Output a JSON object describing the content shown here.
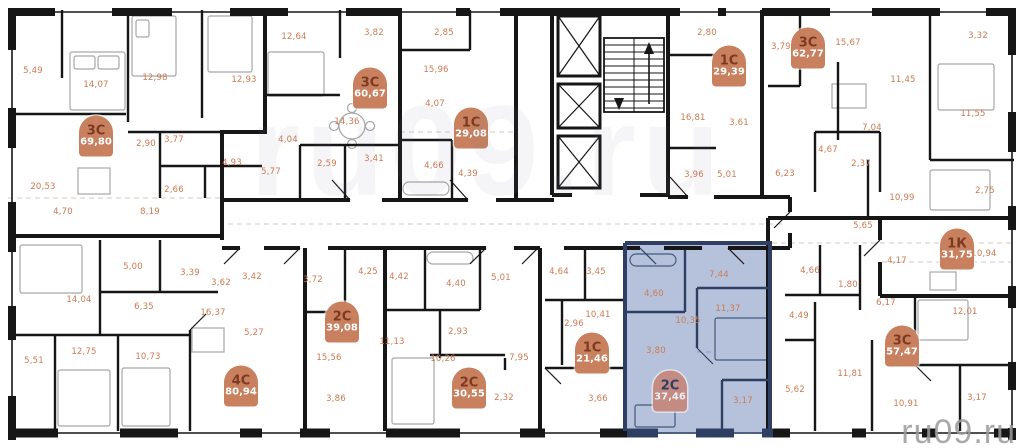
{
  "watermark": {
    "text": "ru09.ru",
    "large_text": "ru09.ru"
  },
  "highlight_color": "#b6c2db",
  "badge_color": "#c8805f",
  "label_color": "#cc7a52",
  "apartments": [
    {
      "id": "3c-69-80",
      "type": "3С",
      "area": "69,80",
      "x": 96,
      "y": 136,
      "highlighted": false
    },
    {
      "id": "3c-60-67",
      "type": "3С",
      "area": "60,67",
      "x": 370,
      "y": 88,
      "highlighted": false
    },
    {
      "id": "1c-29-08",
      "type": "1С",
      "area": "29,08",
      "x": 471,
      "y": 128,
      "highlighted": false
    },
    {
      "id": "1c-29-39",
      "type": "1С",
      "area": "29,39",
      "x": 729,
      "y": 66,
      "highlighted": false
    },
    {
      "id": "3c-62-77",
      "type": "3С",
      "area": "62,77",
      "x": 808,
      "y": 48,
      "highlighted": false
    },
    {
      "id": "1k-31-75",
      "type": "1К",
      "area": "31,75",
      "x": 957,
      "y": 249,
      "highlighted": false
    },
    {
      "id": "3c-57-47",
      "type": "3С",
      "area": "57,47",
      "x": 902,
      "y": 346,
      "highlighted": false
    },
    {
      "id": "4c-80-94",
      "type": "4С",
      "area": "80,94",
      "x": 241,
      "y": 386,
      "highlighted": false
    },
    {
      "id": "2c-39-08",
      "type": "2С",
      "area": "39,08",
      "x": 342,
      "y": 322,
      "highlighted": false
    },
    {
      "id": "2c-30-55",
      "type": "2С",
      "area": "30,55",
      "x": 469,
      "y": 388,
      "highlighted": false
    },
    {
      "id": "1c-21-46",
      "type": "1С",
      "area": "21,46",
      "x": 592,
      "y": 353,
      "highlighted": false
    },
    {
      "id": "2c-37-46",
      "type": "2С",
      "area": "37,46",
      "x": 670,
      "y": 391,
      "highlighted": true
    }
  ],
  "rooms": [
    {
      "v": "5,49",
      "x": 33,
      "y": 71
    },
    {
      "v": "14,07",
      "x": 96,
      "y": 85
    },
    {
      "v": "12,98",
      "x": 155,
      "y": 78
    },
    {
      "v": "12,93",
      "x": 244,
      "y": 80
    },
    {
      "v": "2,90",
      "x": 146,
      "y": 144
    },
    {
      "v": "3,77",
      "x": 174,
      "y": 140
    },
    {
      "v": "4,93",
      "x": 232,
      "y": 163
    },
    {
      "v": "2,66",
      "x": 174,
      "y": 190
    },
    {
      "v": "20,53",
      "x": 43,
      "y": 187
    },
    {
      "v": "4,70",
      "x": 63,
      "y": 212
    },
    {
      "v": "8,19",
      "x": 150,
      "y": 212
    },
    {
      "v": "12,64",
      "x": 294,
      "y": 37
    },
    {
      "v": "3,82",
      "x": 374,
      "y": 33
    },
    {
      "v": "14,36",
      "x": 347,
      "y": 122
    },
    {
      "v": "4,04",
      "x": 288,
      "y": 140
    },
    {
      "v": "2,59",
      "x": 327,
      "y": 164
    },
    {
      "v": "3,41",
      "x": 374,
      "y": 159
    },
    {
      "v": "5,77",
      "x": 271,
      "y": 172
    },
    {
      "v": "2,85",
      "x": 444,
      "y": 33
    },
    {
      "v": "15,96",
      "x": 436,
      "y": 70
    },
    {
      "v": "4,07",
      "x": 435,
      "y": 104
    },
    {
      "v": "4,66",
      "x": 434,
      "y": 166
    },
    {
      "v": "4,39",
      "x": 468,
      "y": 174
    },
    {
      "v": "2,80",
      "x": 707,
      "y": 33
    },
    {
      "v": "16,81",
      "x": 693,
      "y": 118
    },
    {
      "v": "3,61",
      "x": 739,
      "y": 123
    },
    {
      "v": "3,96",
      "x": 694,
      "y": 175
    },
    {
      "v": "5,01",
      "x": 727,
      "y": 175
    },
    {
      "v": "3,79",
      "x": 781,
      "y": 47
    },
    {
      "v": "15,67",
      "x": 848,
      "y": 43
    },
    {
      "v": "3,32",
      "x": 978,
      "y": 36
    },
    {
      "v": "11,45",
      "x": 903,
      "y": 80
    },
    {
      "v": "11,55",
      "x": 973,
      "y": 114
    },
    {
      "v": "7,04",
      "x": 872,
      "y": 128
    },
    {
      "v": "4,67",
      "x": 828,
      "y": 150
    },
    {
      "v": "2,37",
      "x": 861,
      "y": 164
    },
    {
      "v": "6,23",
      "x": 785,
      "y": 174
    },
    {
      "v": "10,99",
      "x": 902,
      "y": 198
    },
    {
      "v": "2,75",
      "x": 985,
      "y": 191
    },
    {
      "v": "4,17",
      "x": 897,
      "y": 261
    },
    {
      "v": "10,94",
      "x": 984,
      "y": 254
    },
    {
      "v": "5,65",
      "x": 863,
      "y": 226
    },
    {
      "v": "4,66",
      "x": 810,
      "y": 271
    },
    {
      "v": "1,80",
      "x": 848,
      "y": 285
    },
    {
      "v": "6,17",
      "x": 886,
      "y": 303
    },
    {
      "v": "4,49",
      "x": 799,
      "y": 316
    },
    {
      "v": "12,01",
      "x": 965,
      "y": 312
    },
    {
      "v": "11,81",
      "x": 850,
      "y": 374
    },
    {
      "v": "5,62",
      "x": 795,
      "y": 390
    },
    {
      "v": "10,91",
      "x": 906,
      "y": 404
    },
    {
      "v": "3,17",
      "x": 977,
      "y": 398
    },
    {
      "v": "5,00",
      "x": 133,
      "y": 267
    },
    {
      "v": "3,39",
      "x": 190,
      "y": 273
    },
    {
      "v": "3,62",
      "x": 221,
      "y": 283
    },
    {
      "v": "14,04",
      "x": 79,
      "y": 300
    },
    {
      "v": "6,35",
      "x": 144,
      "y": 307
    },
    {
      "v": "16,37",
      "x": 213,
      "y": 313
    },
    {
      "v": "12,75",
      "x": 84,
      "y": 352
    },
    {
      "v": "10,73",
      "x": 148,
      "y": 357
    },
    {
      "v": "5,51",
      "x": 34,
      "y": 361
    },
    {
      "v": "3,42",
      "x": 252,
      "y": 277
    },
    {
      "v": "3,72",
      "x": 313,
      "y": 280
    },
    {
      "v": "4,25",
      "x": 368,
      "y": 272
    },
    {
      "v": "5,27",
      "x": 254,
      "y": 333
    },
    {
      "v": "15,56",
      "x": 329,
      "y": 358
    },
    {
      "v": "3,86",
      "x": 336,
      "y": 399
    },
    {
      "v": "4,42",
      "x": 399,
      "y": 277
    },
    {
      "v": "4,40",
      "x": 456,
      "y": 284
    },
    {
      "v": "5,01",
      "x": 501,
      "y": 278
    },
    {
      "v": "11,13",
      "x": 392,
      "y": 342
    },
    {
      "v": "2,93",
      "x": 458,
      "y": 332
    },
    {
      "v": "10,26",
      "x": 443,
      "y": 359
    },
    {
      "v": "7,95",
      "x": 519,
      "y": 358
    },
    {
      "v": "2,32",
      "x": 504,
      "y": 398
    },
    {
      "v": "4,64",
      "x": 559,
      "y": 272
    },
    {
      "v": "3,45",
      "x": 596,
      "y": 272
    },
    {
      "v": "10,41",
      "x": 598,
      "y": 315
    },
    {
      "v": "2,96",
      "x": 574,
      "y": 324
    },
    {
      "v": "3,66",
      "x": 598,
      "y": 399
    },
    {
      "v": "7,44",
      "x": 719,
      "y": 275
    },
    {
      "v": "4,60",
      "x": 654,
      "y": 294
    },
    {
      "v": "11,37",
      "x": 728,
      "y": 309
    },
    {
      "v": "10,35",
      "x": 688,
      "y": 321
    },
    {
      "v": "3,80",
      "x": 656,
      "y": 351
    },
    {
      "v": "3,17",
      "x": 743,
      "y": 401
    }
  ]
}
